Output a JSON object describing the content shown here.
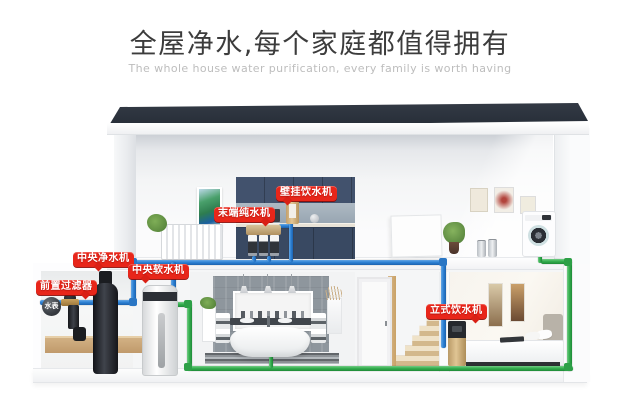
{
  "header": {
    "title": "全屋净水,每个家庭都值得拥有",
    "subtitle": "The whole house water purification, every family is worth having"
  },
  "house": {
    "labels": {
      "wall_mounted_dispenser": "壁挂饮水机",
      "terminal_pure_water": "末端纯水机",
      "central_purifier": "中央净水机",
      "central_softener": "中央软水机",
      "pre_filter": "前置过滤器",
      "water_meter": "水表",
      "standing_dispenser": "立式饮水机"
    }
  },
  "colors": {
    "label_red": "#e8261a",
    "pipe_blue": "#2f83d6",
    "pipe_green": "#36b050",
    "roof": "#2c333d",
    "cabinet_navy": "#3d4c68",
    "title_text": "#3c3c3c",
    "subtitle_text": "#bdbdbd"
  }
}
